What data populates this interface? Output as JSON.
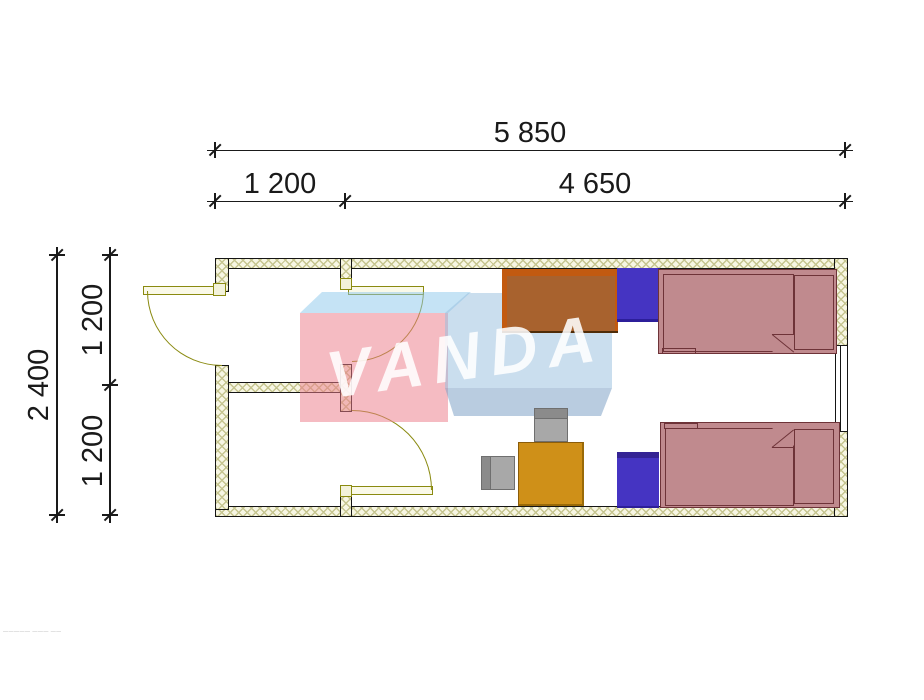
{
  "watermark": {
    "text": "VANDA",
    "brand_red": "#f2a2ad",
    "brand_blue": "#c9dff0"
  },
  "dimensions": {
    "top_total": "5 850",
    "top_segment_left": "1 200",
    "top_segment_right": "4 650",
    "left_total": "2 400",
    "left_segment_upper": "1 200",
    "left_segment_lower": "1 200"
  },
  "plan": {
    "wall_fill": "#f7f6e3",
    "wall_hatch": "#c6c590",
    "door_color": "#8a8a10",
    "rooms": [
      {
        "name": "vestibule"
      },
      {
        "name": "utility-room"
      },
      {
        "name": "living-room"
      }
    ],
    "furniture": [
      {
        "name": "desk",
        "color": "#c25a10"
      },
      {
        "name": "nightstand-top",
        "color": "#4534c2"
      },
      {
        "name": "bed-top",
        "color": "#c08a8e"
      },
      {
        "name": "chair-top",
        "color": "#a8a8a8"
      },
      {
        "name": "chair-left",
        "color": "#a8a8a8"
      },
      {
        "name": "table",
        "color": "#cf9018"
      },
      {
        "name": "nightstand-bottom",
        "color": "#4534c2"
      },
      {
        "name": "bed-bottom",
        "color": "#c08a8e"
      }
    ]
  },
  "fine_print": "――――― ――― ―― ――"
}
